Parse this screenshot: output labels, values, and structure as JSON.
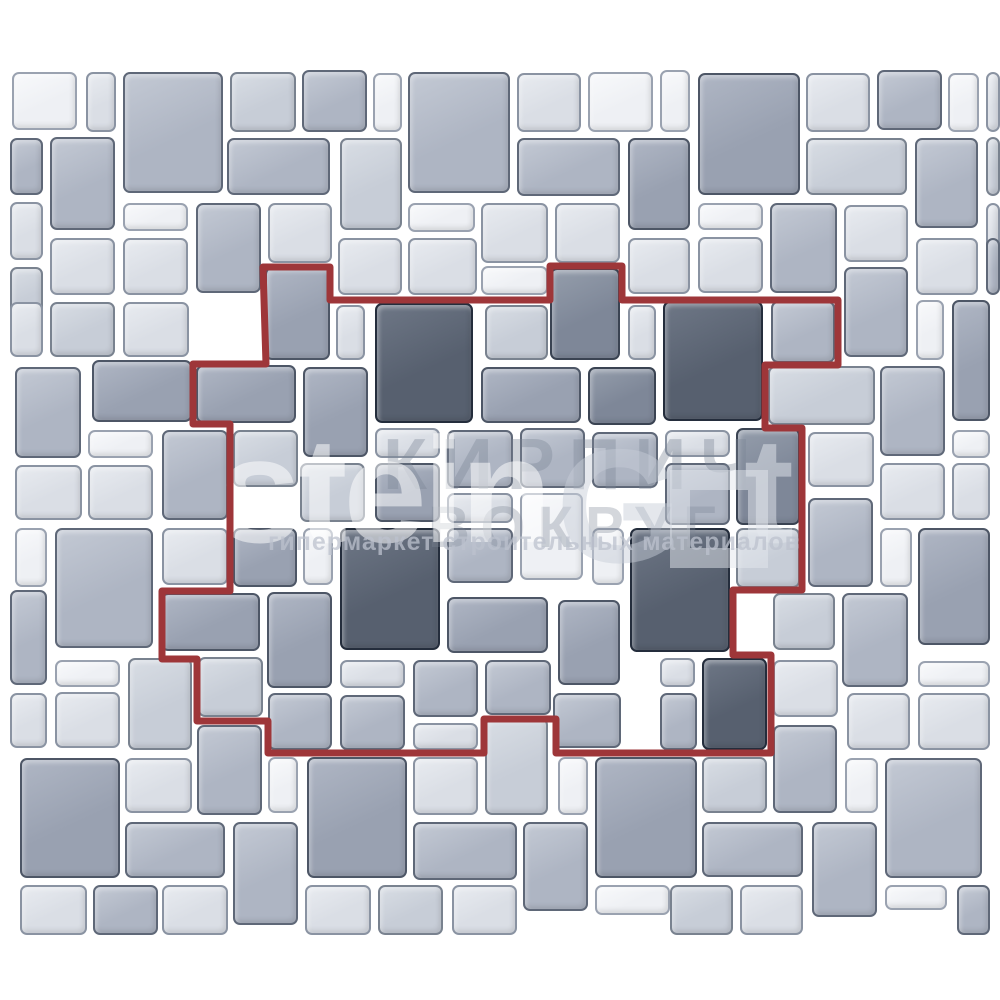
{
  "canvas": {
    "width": 1000,
    "height": 1000,
    "background": "#ffffff"
  },
  "palette": {
    "fills": [
      "#eef0f4",
      "#dadee5",
      "#c7cdd7",
      "#aeb5c3",
      "#99a1b1",
      "#7e8798",
      "#57606f"
    ],
    "highlights": [
      "#f8f9fb",
      "#e8ebf0",
      "#d8dde4",
      "#c3c9d4",
      "#afb6c4",
      "#949dab",
      "#6e7786"
    ],
    "borders": [
      "#9aa2b0",
      "#8a93a2",
      "#79828f",
      "#5f6878",
      "#4d5666",
      "#3a4352",
      "#242d3c"
    ],
    "red_outline": "#9e3639"
  },
  "outline": {
    "stroke_width": 7,
    "points": [
      [
        263,
        267
      ],
      [
        330,
        267
      ],
      [
        330,
        300
      ],
      [
        550,
        300
      ],
      [
        550,
        266
      ],
      [
        622,
        266
      ],
      [
        622,
        300
      ],
      [
        838,
        300
      ],
      [
        838,
        365
      ],
      [
        765,
        365
      ],
      [
        765,
        428
      ],
      [
        802,
        428
      ],
      [
        802,
        590
      ],
      [
        733,
        590
      ],
      [
        733,
        655
      ],
      [
        771,
        655
      ],
      [
        771,
        753
      ],
      [
        556,
        753
      ],
      [
        556,
        719
      ],
      [
        484,
        719
      ],
      [
        484,
        753
      ],
      [
        268,
        753
      ],
      [
        268,
        721
      ],
      [
        197,
        721
      ],
      [
        197,
        659
      ],
      [
        162,
        659
      ],
      [
        162,
        591
      ],
      [
        230,
        591
      ],
      [
        230,
        424
      ],
      [
        193,
        424
      ],
      [
        193,
        364
      ],
      [
        266,
        364
      ]
    ]
  },
  "watermark": {
    "brand_stein": "stein",
    "brand_g": "G",
    "brand_t": "t",
    "ru_line1": "КИРПИЧ",
    "ru_line2": "ВОКРУГ",
    "tagline": "гипермаркет строительных материалов"
  },
  "tiles": [
    [
      12,
      72,
      65,
      58,
      0
    ],
    [
      86,
      72,
      30,
      60,
      1
    ],
    [
      123,
      72,
      100,
      121,
      3
    ],
    [
      230,
      72,
      66,
      60,
      2
    ],
    [
      302,
      70,
      65,
      62,
      3
    ],
    [
      373,
      73,
      29,
      59,
      0
    ],
    [
      408,
      72,
      102,
      121,
      3
    ],
    [
      517,
      73,
      64,
      59,
      1
    ],
    [
      588,
      72,
      65,
      60,
      0
    ],
    [
      660,
      70,
      30,
      62,
      0
    ],
    [
      698,
      73,
      102,
      122,
      4
    ],
    [
      806,
      73,
      64,
      59,
      1
    ],
    [
      877,
      70,
      65,
      60,
      3
    ],
    [
      948,
      73,
      31,
      59,
      0
    ],
    [
      986,
      72,
      14,
      60,
      1
    ],
    [
      10,
      138,
      33,
      57,
      3
    ],
    [
      50,
      137,
      65,
      93,
      3
    ],
    [
      227,
      138,
      103,
      57,
      3
    ],
    [
      340,
      138,
      62,
      92,
      2
    ],
    [
      517,
      138,
      103,
      58,
      3
    ],
    [
      628,
      138,
      62,
      92,
      4
    ],
    [
      806,
      138,
      101,
      57,
      2
    ],
    [
      915,
      138,
      63,
      90,
      3
    ],
    [
      986,
      137,
      14,
      59,
      2
    ],
    [
      10,
      202,
      33,
      58,
      1
    ],
    [
      123,
      203,
      65,
      28,
      0
    ],
    [
      196,
      203,
      65,
      90,
      3
    ],
    [
      268,
      203,
      64,
      60,
      1
    ],
    [
      408,
      203,
      67,
      29,
      0
    ],
    [
      481,
      203,
      67,
      60,
      1
    ],
    [
      555,
      203,
      65,
      60,
      1
    ],
    [
      698,
      203,
      65,
      27,
      0
    ],
    [
      770,
      203,
      67,
      90,
      3
    ],
    [
      844,
      205,
      64,
      57,
      1
    ],
    [
      916,
      238,
      62,
      57,
      1
    ],
    [
      986,
      203,
      14,
      57,
      1
    ],
    [
      10,
      267,
      33,
      57,
      2
    ],
    [
      50,
      238,
      65,
      57,
      1
    ],
    [
      123,
      238,
      65,
      57,
      1
    ],
    [
      338,
      238,
      64,
      57,
      1
    ],
    [
      408,
      238,
      69,
      57,
      1
    ],
    [
      481,
      266,
      67,
      29,
      0
    ],
    [
      628,
      238,
      62,
      56,
      1
    ],
    [
      698,
      237,
      65,
      56,
      1
    ],
    [
      844,
      267,
      64,
      90,
      3
    ],
    [
      986,
      238,
      14,
      57,
      3
    ],
    [
      10,
      302,
      33,
      55,
      1
    ],
    [
      50,
      302,
      65,
      55,
      2
    ],
    [
      123,
      302,
      66,
      55,
      1
    ],
    [
      265,
      267,
      65,
      93,
      4
    ],
    [
      550,
      268,
      70,
      92,
      5
    ],
    [
      336,
      305,
      29,
      55,
      1
    ],
    [
      375,
      303,
      98,
      120,
      6
    ],
    [
      485,
      305,
      63,
      55,
      2
    ],
    [
      628,
      305,
      28,
      55,
      1
    ],
    [
      663,
      301,
      100,
      120,
      6
    ],
    [
      771,
      301,
      64,
      62,
      3
    ],
    [
      916,
      300,
      28,
      60,
      0
    ],
    [
      952,
      300,
      38,
      121,
      4
    ],
    [
      15,
      367,
      66,
      91,
      3
    ],
    [
      92,
      360,
      100,
      62,
      4
    ],
    [
      196,
      365,
      100,
      58,
      4
    ],
    [
      303,
      367,
      65,
      90,
      4
    ],
    [
      481,
      367,
      100,
      56,
      4
    ],
    [
      588,
      367,
      68,
      58,
      5
    ],
    [
      768,
      366,
      107,
      59,
      2
    ],
    [
      880,
      366,
      65,
      90,
      3
    ],
    [
      952,
      430,
      38,
      28,
      0
    ],
    [
      88,
      430,
      65,
      28,
      0
    ],
    [
      162,
      430,
      66,
      90,
      3
    ],
    [
      233,
      430,
      65,
      57,
      2
    ],
    [
      375,
      428,
      65,
      30,
      1
    ],
    [
      447,
      430,
      66,
      58,
      3
    ],
    [
      520,
      428,
      65,
      60,
      3
    ],
    [
      592,
      432,
      66,
      56,
      3
    ],
    [
      665,
      430,
      65,
      27,
      1
    ],
    [
      736,
      428,
      64,
      97,
      5
    ],
    [
      808,
      432,
      66,
      55,
      1
    ],
    [
      952,
      463,
      38,
      57,
      1
    ],
    [
      15,
      465,
      67,
      55,
      1
    ],
    [
      88,
      465,
      65,
      55,
      1
    ],
    [
      300,
      463,
      65,
      59,
      2
    ],
    [
      375,
      463,
      65,
      59,
      4
    ],
    [
      447,
      493,
      66,
      30,
      1
    ],
    [
      520,
      493,
      63,
      87,
      0
    ],
    [
      665,
      463,
      65,
      62,
      3
    ],
    [
      808,
      498,
      65,
      89,
      3
    ],
    [
      880,
      463,
      65,
      57,
      1
    ],
    [
      15,
      528,
      32,
      59,
      0
    ],
    [
      55,
      528,
      98,
      120,
      3
    ],
    [
      162,
      528,
      66,
      57,
      1
    ],
    [
      233,
      528,
      64,
      59,
      4
    ],
    [
      303,
      528,
      30,
      57,
      0
    ],
    [
      340,
      528,
      100,
      122,
      6
    ],
    [
      447,
      528,
      66,
      55,
      3
    ],
    [
      592,
      528,
      32,
      57,
      0
    ],
    [
      630,
      528,
      100,
      124,
      6
    ],
    [
      736,
      528,
      64,
      60,
      2
    ],
    [
      880,
      528,
      32,
      59,
      0
    ],
    [
      918,
      528,
      72,
      117,
      4
    ],
    [
      10,
      590,
      37,
      95,
      3
    ],
    [
      161,
      593,
      99,
      58,
      4
    ],
    [
      267,
      592,
      65,
      96,
      4
    ],
    [
      447,
      597,
      101,
      56,
      4
    ],
    [
      558,
      600,
      62,
      85,
      4
    ],
    [
      773,
      593,
      62,
      57,
      2
    ],
    [
      842,
      593,
      66,
      94,
      3
    ],
    [
      55,
      660,
      65,
      27,
      0
    ],
    [
      55,
      692,
      65,
      56,
      1
    ],
    [
      10,
      693,
      37,
      55,
      1
    ],
    [
      128,
      658,
      64,
      92,
      2
    ],
    [
      198,
      657,
      65,
      60,
      2
    ],
    [
      268,
      693,
      64,
      57,
      3
    ],
    [
      340,
      660,
      65,
      28,
      1
    ],
    [
      413,
      660,
      65,
      57,
      3
    ],
    [
      485,
      660,
      66,
      55,
      3
    ],
    [
      340,
      695,
      65,
      55,
      3
    ],
    [
      413,
      723,
      65,
      27,
      1
    ],
    [
      485,
      718,
      63,
      97,
      2
    ],
    [
      553,
      693,
      68,
      55,
      3
    ],
    [
      660,
      658,
      35,
      29,
      1
    ],
    [
      660,
      693,
      37,
      57,
      3
    ],
    [
      702,
      658,
      65,
      92,
      6
    ],
    [
      773,
      660,
      65,
      57,
      1
    ],
    [
      773,
      725,
      64,
      88,
      3
    ],
    [
      847,
      693,
      63,
      57,
      1
    ],
    [
      918,
      661,
      72,
      26,
      0
    ],
    [
      918,
      693,
      72,
      57,
      1
    ],
    [
      20,
      758,
      100,
      120,
      4
    ],
    [
      125,
      758,
      67,
      55,
      1
    ],
    [
      197,
      725,
      65,
      90,
      3
    ],
    [
      268,
      757,
      30,
      56,
      0
    ],
    [
      307,
      757,
      100,
      121,
      4
    ],
    [
      413,
      757,
      65,
      58,
      1
    ],
    [
      558,
      757,
      30,
      58,
      0
    ],
    [
      595,
      757,
      102,
      121,
      4
    ],
    [
      702,
      757,
      65,
      56,
      2
    ],
    [
      845,
      758,
      33,
      55,
      0
    ],
    [
      885,
      758,
      97,
      120,
      3
    ],
    [
      125,
      822,
      100,
      56,
      3
    ],
    [
      233,
      822,
      65,
      103,
      3
    ],
    [
      413,
      822,
      104,
      58,
      3
    ],
    [
      523,
      822,
      65,
      89,
      3
    ],
    [
      702,
      822,
      101,
      55,
      3
    ],
    [
      812,
      822,
      65,
      95,
      3
    ],
    [
      20,
      885,
      67,
      50,
      1
    ],
    [
      93,
      885,
      65,
      50,
      3
    ],
    [
      162,
      885,
      66,
      50,
      1
    ],
    [
      305,
      885,
      66,
      50,
      1
    ],
    [
      378,
      885,
      65,
      50,
      2
    ],
    [
      452,
      885,
      65,
      50,
      1
    ],
    [
      595,
      885,
      75,
      30,
      0
    ],
    [
      670,
      885,
      63,
      50,
      2
    ],
    [
      740,
      885,
      63,
      50,
      1
    ],
    [
      885,
      885,
      62,
      25,
      0
    ],
    [
      957,
      885,
      33,
      50,
      3
    ]
  ]
}
